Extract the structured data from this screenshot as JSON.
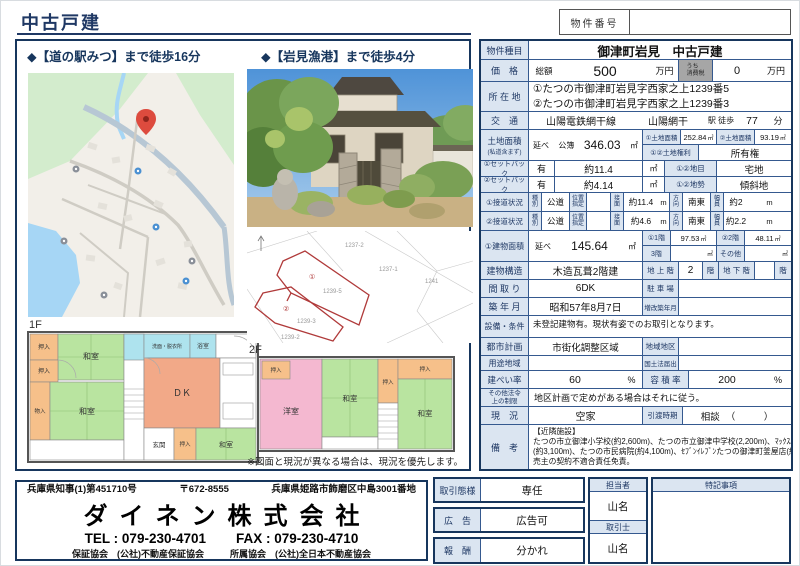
{
  "header": {
    "title": "中古戸建",
    "property_no_label": "物件番号"
  },
  "left": {
    "map_caption": "◆【道の駅みつ】まで徒歩16分",
    "photo_caption": "◆【岩見漁港】まで徒歩4分",
    "floor1": "1F",
    "floor2": "2F",
    "note": "※図面と現況が異なる場合は、現況を優先します。",
    "plan": {
      "washitsu": "和室",
      "oshiire": "押入",
      "monoire": "物入",
      "dk": "ＤＫ",
      "bath": "浴室",
      "washroom": "洗面・脱衣所",
      "genkan": "玄関",
      "youshitsu": "洋室"
    },
    "cadastral": {
      "p1_no": "①",
      "p1_lot": "1239-5",
      "p2_no": "②",
      "p2_lot": "1239-3",
      "n1": "1237-2",
      "n2": "1237-1",
      "n3": "1241",
      "n4": "1239-2"
    }
  },
  "table": {
    "type_label": "物件種目",
    "type_value": "御津町岩見　中古戸建",
    "price_label": "価　格",
    "total_label": "総額",
    "price": "500",
    "unit_man": "万円",
    "tax_label": "うち\n消費税",
    "tax": "0",
    "addr_label": "所 在 地",
    "addr1": "①たつの市御津町岩見字西家之上1239番5",
    "addr2": "②たつの市御津町岩見字西家之上1239番3",
    "traffic_label": "交　通",
    "line": "山陽電鉄網干線",
    "station": "山陽網干",
    "walk_label": "駅 徒歩",
    "walk": "77",
    "min": "分",
    "land_label": "土地面積",
    "land_sub": "(私道含まず)",
    "nobe": "延べ",
    "koubo": "公簿",
    "land_total": "346.03",
    "sqm": "㎡",
    "land1_label": "①土地面積",
    "land1": "252.84",
    "land2_label": "②土地面積",
    "land2": "93.19",
    "right_label": "①②土地権利",
    "right_value": "所有権",
    "sb1_label": "①セットバック",
    "sb1_flag": "有",
    "sb1": "約11.4",
    "mokuteki_label": "①②地目",
    "mokuteki": "宅地",
    "sb2_label": "②セットバック",
    "sb2_flag": "有",
    "sb2": "約4.14",
    "chisei_label": "①②地勢",
    "chisei": "傾斜地",
    "road1_label": "①接道状況",
    "road2_label": "②接道状況",
    "shubetsu": "種\n別",
    "kodo": "公道",
    "ichi": "位置\n指定",
    "setsumen": "接\n面",
    "m": "m",
    "road1_front": "約11.4",
    "houkou": "方\n向",
    "road1_dir": "南東",
    "fukuin": "幅\n員",
    "road1_w": "約2",
    "road2_front": "約4.6",
    "road2_dir": "南東",
    "road2_w": "約2.2",
    "bldg_label": "①建物面積",
    "bldg_total": "145.64",
    "f1_label": "①1階",
    "f1": "97.53",
    "f2_label": "②2階",
    "f2": "48.11",
    "f3_label": "3階",
    "other_label": "その他",
    "struct_label": "建物構造",
    "struct": "木造瓦葺2階建",
    "above_label": "地 上 階",
    "above": "2",
    "kai": "階",
    "below_label": "地 下 階",
    "madori_label": "間 取 り",
    "madori": "6DK",
    "parking_label": "駐 車 場",
    "chiku_label": "築 年 月",
    "chiku": "昭和57年8月7日",
    "zoukai_label": "増改築年月",
    "setsubi_label": "設備・条件",
    "setsubi": "未登記建物有。現状有姿でのお取引となります。",
    "toshi_label": "都市計画",
    "toshi": "市街化調整区域",
    "chiiki_label": "地域地区",
    "youto_label": "用途地域",
    "kokudo_label": "国土法届出",
    "kenpei_label": "建ぺい率",
    "kenpei": "60",
    "pct": "%",
    "yoseki_label": "容 積 率",
    "yoseki": "200",
    "hourei_label": "その他法令\n上の制限",
    "hourei": "地区計画で定めがある場合はそれに従う。",
    "genkyo_label": "現　況",
    "genkyo": "空家",
    "hikiwatashi_label": "引渡時期",
    "hikiwatashi": "相談",
    "paren": "（　　　）",
    "biko_label": "備　考",
    "biko1": "【近隣施設】",
    "biko2": "たつの市立御津小学校(約2,600m)、たつの市立御津中学校(2,200m)、ﾏｯｸｽﾊﾞﾘｭ御津店",
    "biko3": "(約3,100m)、たつの市民病院(約4,100m)、ｾﾌﾞﾝｲﾚﾌﾞﾝたつの御津町釜屋店(約",
    "biko4": "売主の契約不適合責任免責。"
  },
  "company": {
    "license": "兵庫県知事(1)第451710号",
    "postal": "〒672-8555",
    "address": "兵庫県姫路市飾磨区中島3001番地",
    "name": "ダイネン株式会社",
    "tel": "TEL : 079-230-4701",
    "fax": "FAX : 079-230-4710",
    "guarantee": "保証協会　(公社)不動産保証協会",
    "association": "所属協会　(公社)全日本不動産協会"
  },
  "deal": {
    "mode_label": "取引態様",
    "mode_value": "専任",
    "ad_label": "広　告",
    "ad_value": "広告可",
    "fee_label": "報　酬",
    "fee_value": "分かれ",
    "staff_label": "担当者",
    "staff_name": "山名",
    "agent_label": "取引士",
    "agent_name": "山名",
    "notes_label": "特記事項"
  },
  "colors": {
    "navy": "#17365d",
    "label_bg": "#dbe5f1",
    "pin_red": "#dd4b3e"
  }
}
